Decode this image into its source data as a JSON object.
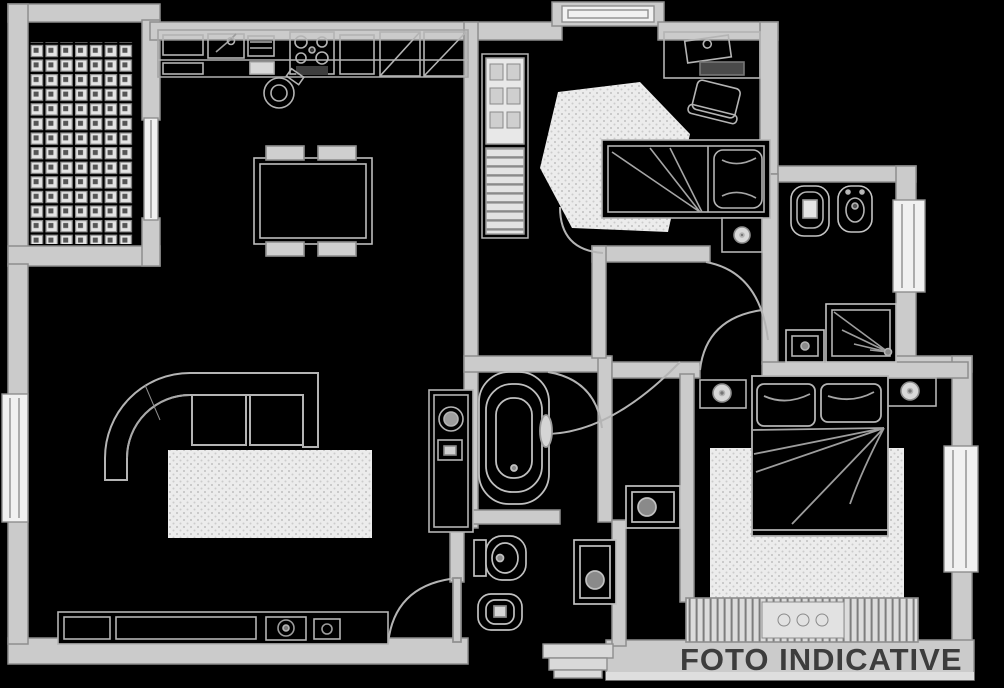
{
  "watermark": {
    "label": "FOTO INDICATIVE",
    "color": "#3d3d3d"
  },
  "palette": {
    "background": "#000000",
    "wall_fill": "#cbcbcb",
    "wall_stroke": "#8e8e8e",
    "line": "#b4b4b4",
    "line_soft": "#9d9d9d",
    "fixture_fill": "#f1f1f1",
    "rug_fill": "#e9e9e9",
    "dark_accent": "#3d3d3d"
  },
  "plan": {
    "type": "floor-plan",
    "rooms": [
      {
        "name": "terrace-tiled"
      },
      {
        "name": "kitchen-dining"
      },
      {
        "name": "living-room"
      },
      {
        "name": "entry-hall"
      },
      {
        "name": "bedroom-single"
      },
      {
        "name": "bathroom-main"
      },
      {
        "name": "wc-second"
      },
      {
        "name": "bathroom-shower"
      },
      {
        "name": "bedroom-master"
      }
    ],
    "fixtures": [
      "kitchen-counter",
      "kitchen-sink",
      "stove-burners",
      "fridge-columns",
      "dining-table-with-chairs",
      "stool",
      "wardrobe-shelves",
      "wardrobe-hangers",
      "desk-with-chair",
      "single-bed",
      "nightstand-lamp",
      "bathtub",
      "washing-machine-column",
      "toilet",
      "bidet",
      "washbasin",
      "shower-stall",
      "corner-sofa",
      "area-rug",
      "tv-sideboard",
      "double-bed-with-pillows",
      "radiator",
      "entrance-threshold",
      "door-swing-arcs",
      "windows"
    ]
  }
}
